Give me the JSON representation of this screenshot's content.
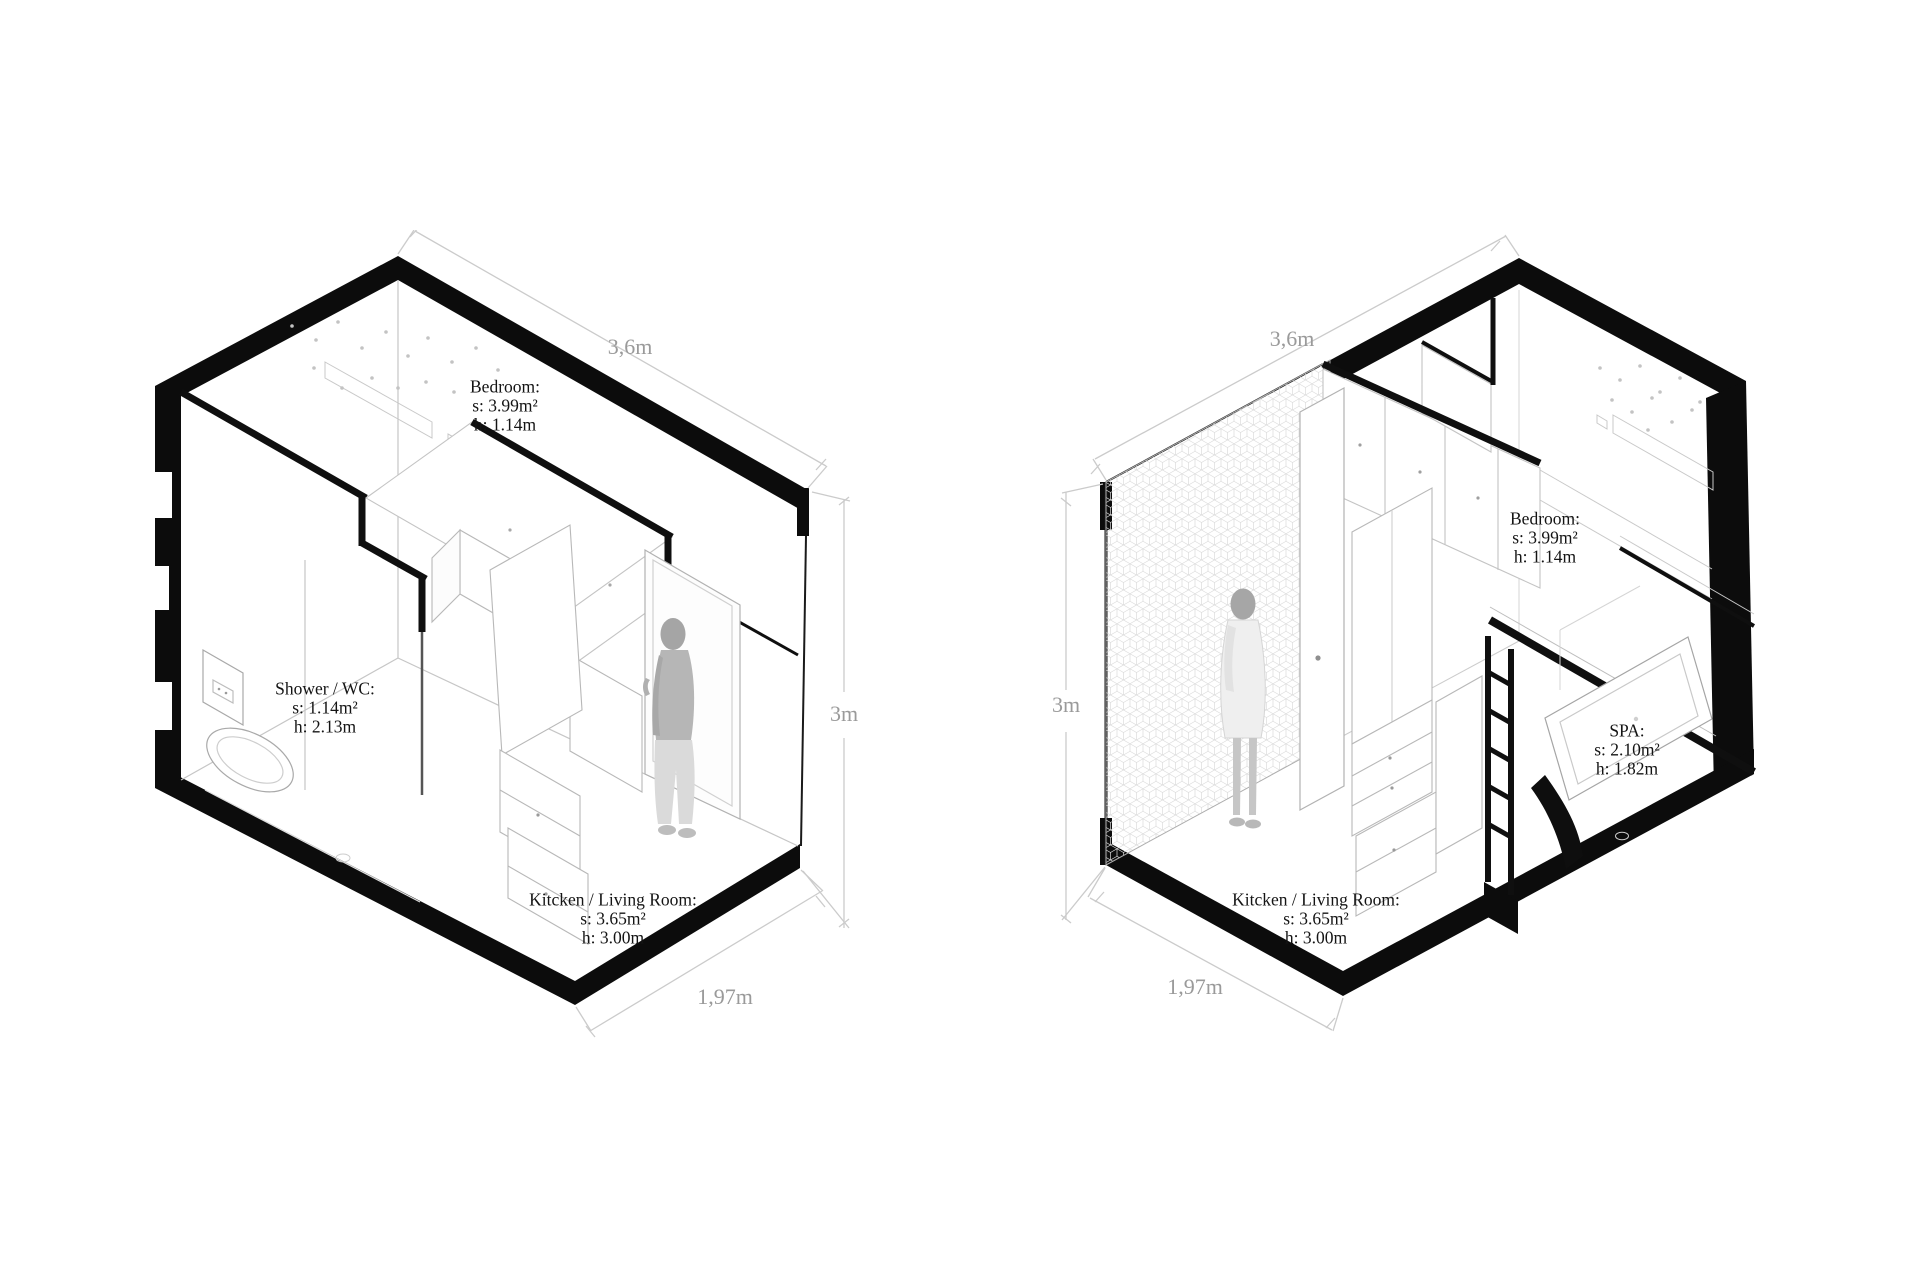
{
  "colors": {
    "background": "#ffffff",
    "ink": "#0c0c0c",
    "furniture_line": "#b8b8b8",
    "dimension_line": "#cbcbcb",
    "dimension_text": "#9a9a9a",
    "label_text": "#141414"
  },
  "units": {
    "left": {
      "dims": {
        "width": "3,6m",
        "height": "3m",
        "depth": "1,97m"
      },
      "rooms": [
        {
          "id": "bedroom",
          "lines": [
            "Bedroom:",
            "s: 3.99m²",
            "h: 1.14m"
          ]
        },
        {
          "id": "shower-wc",
          "lines": [
            "Shower / WC:",
            "s: 1.14m²",
            "h: 2.13m"
          ]
        },
        {
          "id": "kitchen-living",
          "lines": [
            "Kitcken / Living Room:",
            "s: 3.65m²",
            "h: 3.00m"
          ]
        }
      ]
    },
    "right": {
      "dims": {
        "width": "3,6m",
        "height": "3m",
        "depth": "1,97m"
      },
      "rooms": [
        {
          "id": "bedroom",
          "lines": [
            "Bedroom:",
            "s: 3.99m²",
            "h: 1.14m"
          ]
        },
        {
          "id": "spa",
          "lines": [
            "SPA:",
            "s: 2.10m²",
            "h: 1.82m"
          ]
        },
        {
          "id": "kitchen-living",
          "lines": [
            "Kitcken / Living Room:",
            "s: 3.65m²",
            "h: 3.00m"
          ]
        }
      ]
    }
  }
}
